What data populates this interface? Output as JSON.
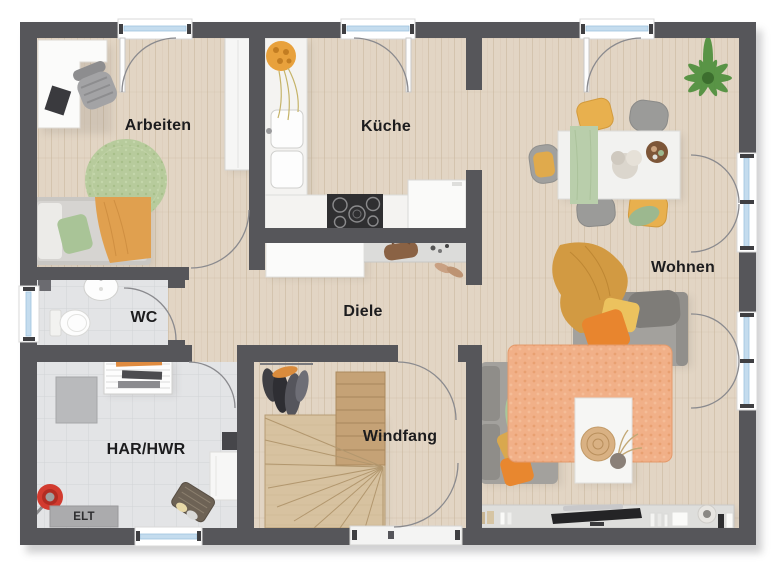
{
  "plan_type": "floor-plan",
  "labels": {
    "arbeiten": "Arbeiten",
    "kueche": "Küche",
    "wohnen": "Wohnen",
    "wc": "WC",
    "diele": "Diele",
    "har_hwr": "HAR/HWR",
    "windfang": "Windfang",
    "elt": "ELT"
  },
  "colors": {
    "wall": "#56565a",
    "wood_floor": "#e2d5c4",
    "stair_wood": "#d7c2a0",
    "stair_upper_run": "#c5a276",
    "tile_floor": "#e3e4e6",
    "window_glass": "#c4dcee",
    "accent_orange": "#e8872f",
    "accent_mustard": "#d29a42",
    "accent_green": "#a9c79b",
    "rug_orange": "#f1b088",
    "rug_green": "#b7cb9c",
    "sofa_grey": "#a3a19d"
  }
}
